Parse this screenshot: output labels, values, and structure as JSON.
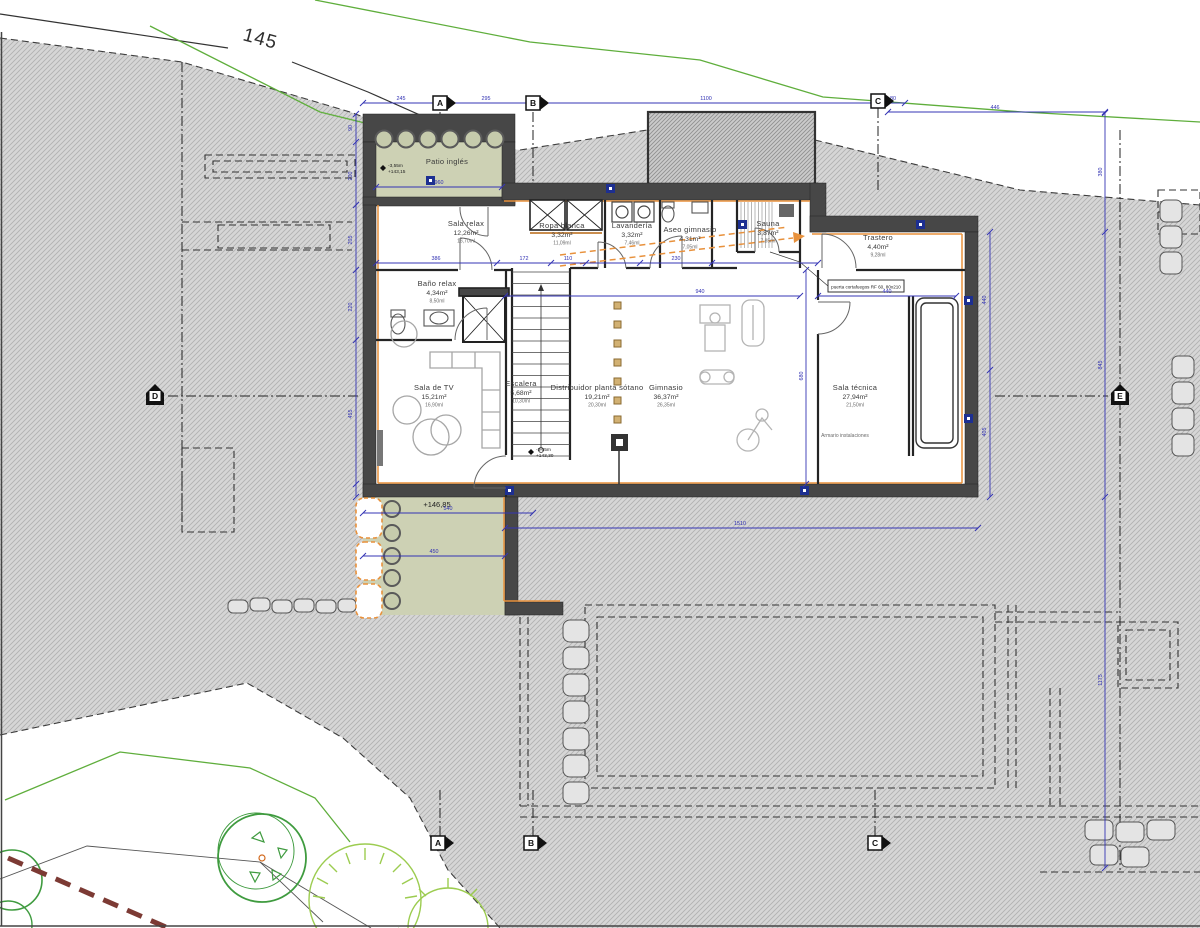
{
  "contour_label": "145",
  "site_level": "+146,85",
  "door_note": "puerta cortafuegos RF 60, 80x210",
  "rooms": [
    {
      "id": "patio-ingles",
      "name": "Patio inglés",
      "area": "",
      "sub": "",
      "x": 447,
      "y": 164
    },
    {
      "id": "sala-relax",
      "name": "Sala relax",
      "area": "12,26m²",
      "sub": "16,70ml",
      "x": 466,
      "y": 226
    },
    {
      "id": "ropa-blanca",
      "name": "Ropa blanca",
      "area": "3,32m²",
      "sub": "11,09ml",
      "x": 562,
      "y": 228
    },
    {
      "id": "lavanderia",
      "name": "Lavandería",
      "area": "3,32m²",
      "sub": "7,46ml",
      "x": 632,
      "y": 228
    },
    {
      "id": "aseo-gimnasio",
      "name": "Aseo gimnasio",
      "area": "4,31m²",
      "sub": "7,05ml",
      "x": 690,
      "y": 232
    },
    {
      "id": "sauna",
      "name": "Sauna",
      "area": "3,87m²",
      "sub": "7,85ml",
      "x": 768,
      "y": 226
    },
    {
      "id": "trastero",
      "name": "Trastero",
      "area": "4,40m²",
      "sub": "9,28ml",
      "x": 878,
      "y": 240
    },
    {
      "id": "bano-relax",
      "name": "Baño relax",
      "area": "4,34m²",
      "sub": "8,50ml",
      "x": 437,
      "y": 286
    },
    {
      "id": "sala-tv",
      "name": "Sala de TV",
      "area": "15,21m²",
      "sub": "16,90ml",
      "x": 434,
      "y": 390
    },
    {
      "id": "escalera",
      "name": "Escalera",
      "area": "5,68m²",
      "sub": "10,30ml",
      "x": 521,
      "y": 386
    },
    {
      "id": "distribuidor",
      "name": "Distribuidor planta sótano",
      "area": "19,21m²",
      "sub": "20,30ml",
      "x": 597,
      "y": 390
    },
    {
      "id": "gimnasio",
      "name": "Gimnasio",
      "area": "36,37m²",
      "sub": "26,35ml",
      "x": 666,
      "y": 390
    },
    {
      "id": "sala-tecnica",
      "name": "Sala técnica",
      "area": "27,94m²",
      "sub": "21,50ml",
      "x": 855,
      "y": 390
    },
    {
      "id": "armario-instalaciones",
      "name": "Armario instalaciones",
      "area": "",
      "sub": "",
      "x": 845,
      "y": 437,
      "small": true
    }
  ],
  "levels": [
    {
      "id": "patio-level",
      "l1": "-3,55m",
      "l2": "+143,15",
      "x": 383,
      "y": 168
    },
    {
      "id": "stair-level",
      "l1": "-3,55m",
      "l2": "+143,30",
      "x": 531,
      "y": 452
    }
  ],
  "markers": [
    {
      "letter": "A",
      "x": 440,
      "y": 103,
      "dir": "right"
    },
    {
      "letter": "B",
      "x": 533,
      "y": 103,
      "dir": "right"
    },
    {
      "letter": "C",
      "x": 878,
      "y": 101,
      "dir": "right"
    },
    {
      "letter": "A",
      "x": 438,
      "y": 843,
      "dir": "right"
    },
    {
      "letter": "B",
      "x": 531,
      "y": 843,
      "dir": "right"
    },
    {
      "letter": "C",
      "x": 875,
      "y": 843,
      "dir": "right"
    },
    {
      "letter": "D",
      "x": 155,
      "y": 396,
      "dir": "up"
    },
    {
      "letter": "E",
      "x": 1120,
      "y": 396,
      "dir": "up"
    }
  ],
  "dims": [
    {
      "v": "245",
      "x": 401,
      "y": 100
    },
    {
      "v": "295",
      "x": 486,
      "y": 100
    },
    {
      "v": "1100",
      "x": 706,
      "y": 100
    },
    {
      "v": "80",
      "x": 893,
      "y": 100
    },
    {
      "v": "446",
      "x": 995,
      "y": 109
    },
    {
      "v": "90",
      "x": 352,
      "y": 128,
      "rot": -90
    },
    {
      "v": "200",
      "x": 352,
      "y": 176,
      "rot": -90
    },
    {
      "v": "205",
      "x": 352,
      "y": 240,
      "rot": -90
    },
    {
      "v": "220",
      "x": 352,
      "y": 307,
      "rot": -90
    },
    {
      "v": "455",
      "x": 352,
      "y": 414,
      "rot": -90
    },
    {
      "v": "960",
      "x": 439,
      "y": 184
    },
    {
      "v": "386",
      "x": 436,
      "y": 260
    },
    {
      "v": "172",
      "x": 524,
      "y": 260
    },
    {
      "v": "110",
      "x": 568,
      "y": 260
    },
    {
      "v": "230",
      "x": 676,
      "y": 260
    },
    {
      "v": "940",
      "x": 700,
      "y": 293
    },
    {
      "v": "440",
      "x": 887,
      "y": 293
    },
    {
      "v": "540",
      "x": 448,
      "y": 510
    },
    {
      "v": "1510",
      "x": 740,
      "y": 525
    },
    {
      "v": "450",
      "x": 434,
      "y": 553
    },
    {
      "v": "440",
      "x": 986,
      "y": 300,
      "rot": -90
    },
    {
      "v": "405",
      "x": 986,
      "y": 432,
      "rot": -90
    },
    {
      "v": "380",
      "x": 1102,
      "y": 172,
      "rot": -90
    },
    {
      "v": "845",
      "x": 1102,
      "y": 365,
      "rot": -90
    },
    {
      "v": "1175",
      "x": 1102,
      "y": 680,
      "rot": -90
    },
    {
      "v": "680",
      "x": 803,
      "y": 376,
      "rot": -90
    }
  ],
  "colors": {
    "terrain_line": "#b0b0b0",
    "wall": "#474747",
    "patio_green": "#cdd1b4",
    "dim_blue": "#3434b4",
    "contour_green": "#5fae3c",
    "accent_orange": "#e8913c",
    "tree_green": "#3f9b3f",
    "bush_green": "#9ccc50",
    "maroon": "#7c3a34"
  }
}
